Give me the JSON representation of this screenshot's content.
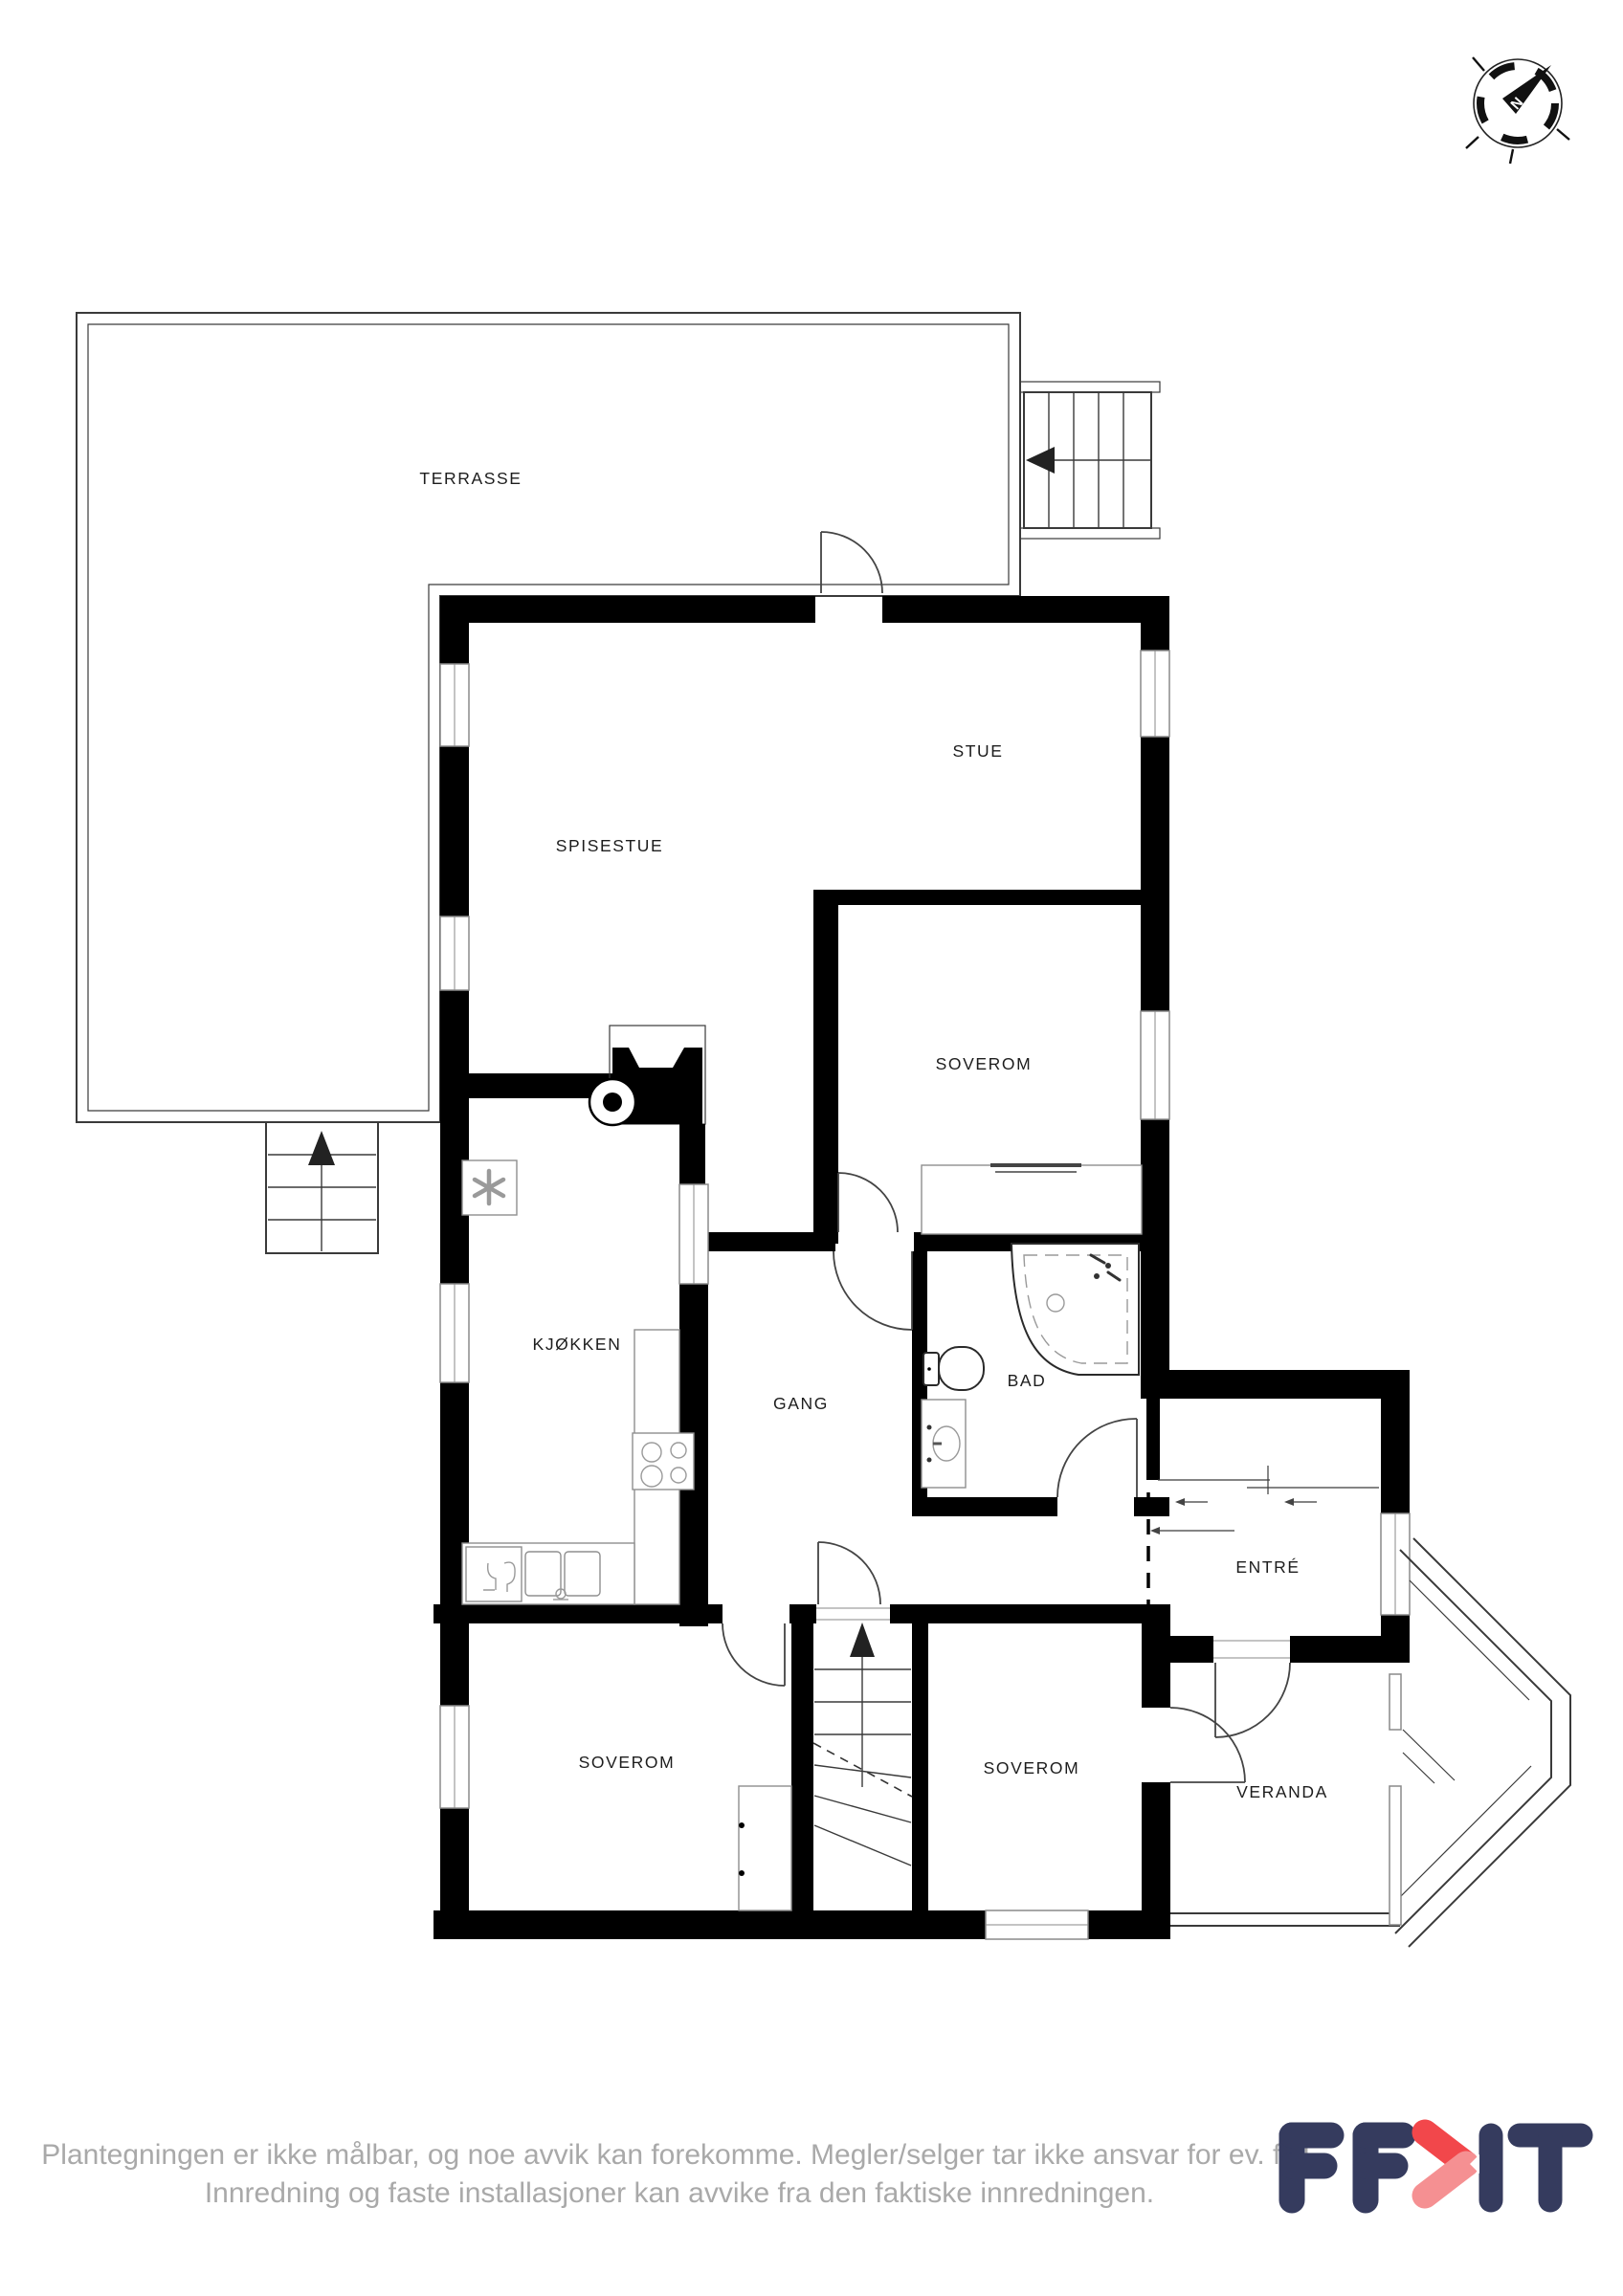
{
  "compass": {
    "label": "N"
  },
  "rooms": {
    "terrasse": "TERRASSE",
    "stue": "STUE",
    "spisestue": "SPISESTUE",
    "soverom_mid": "SOVEROM",
    "kjokken": "KJØKKEN",
    "gang": "GANG",
    "bad": "BAD",
    "entre": "ENTRÉ",
    "soverom_left": "SOVEROM",
    "soverom_right": "SOVEROM",
    "veranda": "VERANDA"
  },
  "footer": {
    "disclaimer_line1": "Plantegningen er ikke målbar, og noe avvik kan forekomme. Megler/selger tar ikke ansvar for ev. feil.",
    "disclaimer_line2": "Innredning og faste installasjoner kan avvike fra den faktiske innredningen.",
    "logo_text": "EFKT"
  },
  "colors": {
    "wall": "#000000",
    "outline": "#3a3a3a",
    "fixture": "#8f8f8f",
    "label": "#1d1d1d",
    "disclaimer": "#a9a9a9",
    "logo_navy": "#353b5e",
    "logo_red": "#f2474b",
    "logo_red_light": "#f59092"
  }
}
